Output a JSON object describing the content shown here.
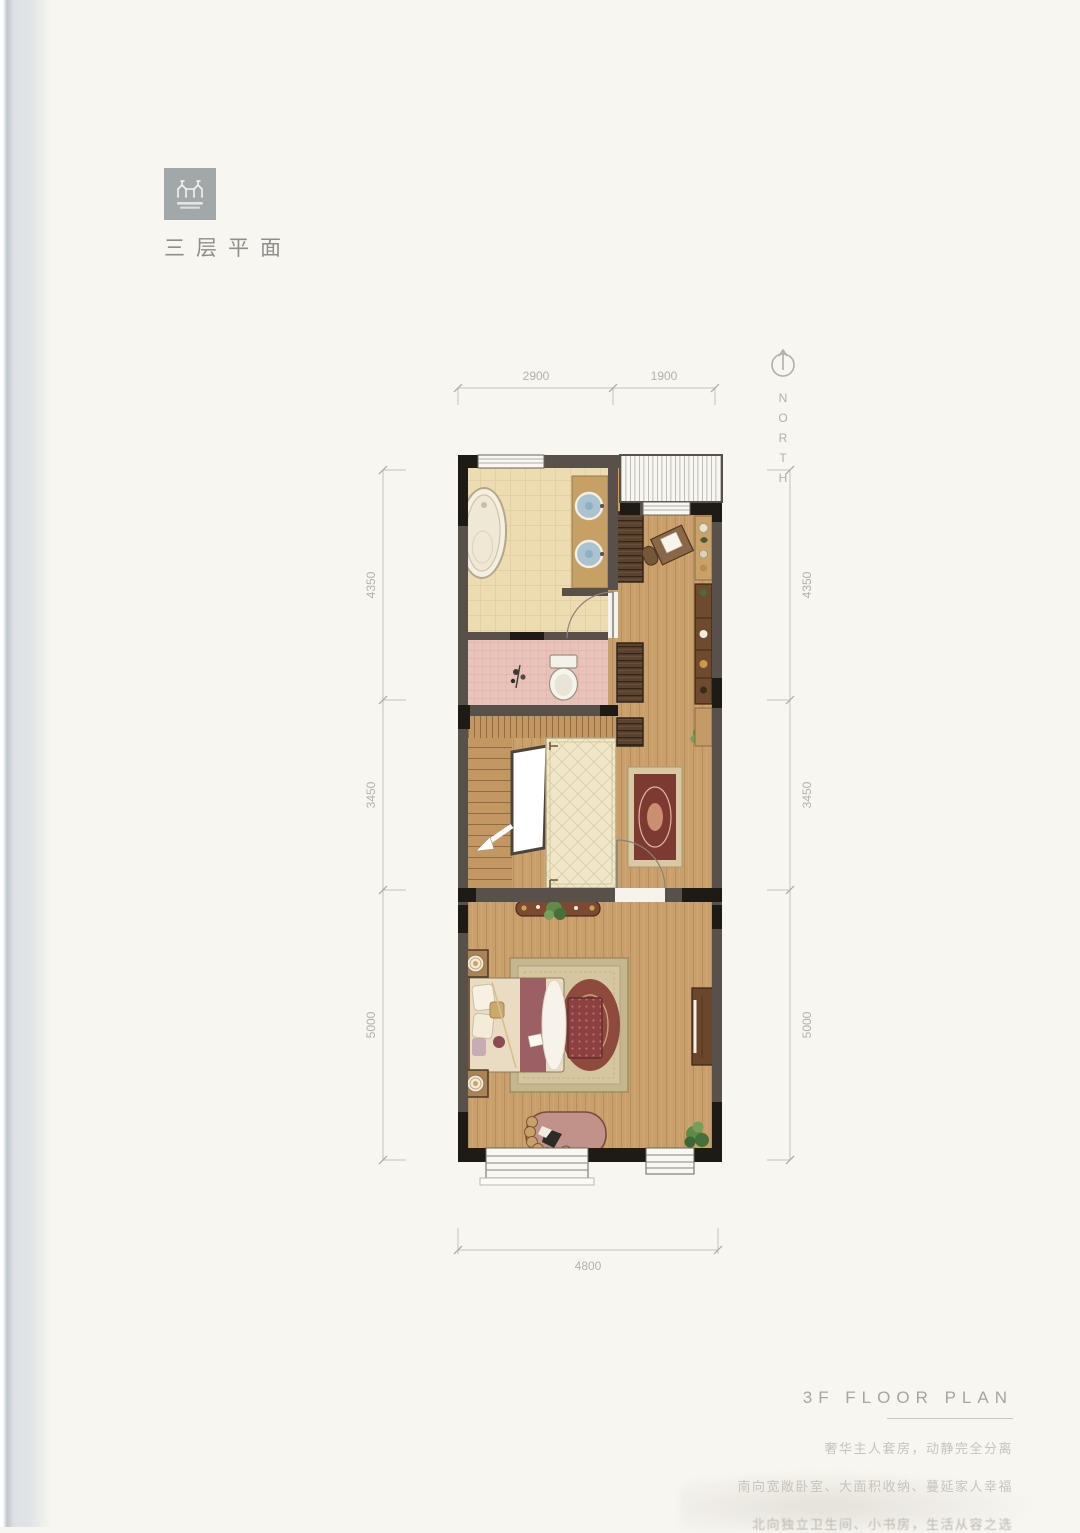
{
  "header": {
    "title": "三层平面"
  },
  "north": {
    "label": "NORTH"
  },
  "dims": {
    "top": [
      "2900",
      "1900"
    ],
    "left": [
      "4350",
      "3450",
      "5000"
    ],
    "right": [
      "4350",
      "3450",
      "5000"
    ],
    "bottom": [
      "4800"
    ]
  },
  "footer": {
    "heading": "3F FLOOR PLAN",
    "line1": "奢华主人套房，动静完全分离",
    "line2": "南向宽敞卧室、大面积收纳、蔓延家人幸福",
    "line3": "北向独立卫生间、小书房，生活从容之选"
  },
  "colors": {
    "page_bg": "#f8f6f0",
    "wall": "#57514a",
    "wall_dark": "#1e1a16",
    "wood_floor": "#c9a06c",
    "bath_tile": "#eddcb2",
    "toilet_tile": "#e9c2b9",
    "hall_tile": "#f0e7ca",
    "sink_blue": "#a9c3d1",
    "rug_burgundy": "#7c3a33",
    "rug_tan": "#c7b58d",
    "wardrobe_brown": "#5a4430",
    "dim_line": "#c6c3bb",
    "text_gray": "#8e8e8a",
    "footer_text": "#c7c4bc"
  }
}
